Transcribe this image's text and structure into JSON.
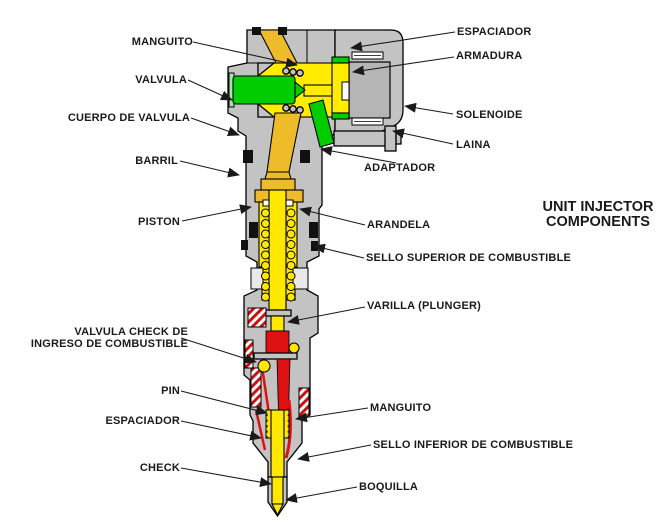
{
  "title": {
    "line1": "UNIT INJECTOR",
    "line2": "COMPONENTS"
  },
  "labels": {
    "manguito_top": "MANGUITO",
    "valvula": "VALVULA",
    "cuerpo_de_valvula": "CUERPO DE VALVULA",
    "barril": "BARRIL",
    "piston": "PISTON",
    "valvula_check_line1": "VALVULA CHECK DE",
    "valvula_check_line2": "INGRESO DE COMBUSTIBLE",
    "pin": "PIN",
    "espaciador_lower": "ESPACIADOR",
    "check": "CHECK",
    "espaciador_top": "ESPACIADOR",
    "armadura": "ARMADURA",
    "solenoide": "SOLENOIDE",
    "laina": "LAINA",
    "adaptador": "ADAPTADOR",
    "arandela": "ARANDELA",
    "sello_superior": "SELLO SUPERIOR DE COMBUSTIBLE",
    "varilla": "VARILLA (PLUNGER)",
    "manguito_lower": "MANGUITO",
    "sello_inferior": "SELLO INFERIOR DE COMBUSTIBLE",
    "boquilla": "BOQUILLA"
  },
  "colors": {
    "body_gray": "#c3c3c3",
    "inner_gray": "#b5b5b5",
    "chamber_yellow": "#ffec00",
    "plunger_yellow": "#ffe800",
    "channel_gold": "#eebc2a",
    "valve_green": "#00cc00",
    "fuel_red": "#dd1111",
    "outline_black": "#111111",
    "background": "#ffffff"
  }
}
